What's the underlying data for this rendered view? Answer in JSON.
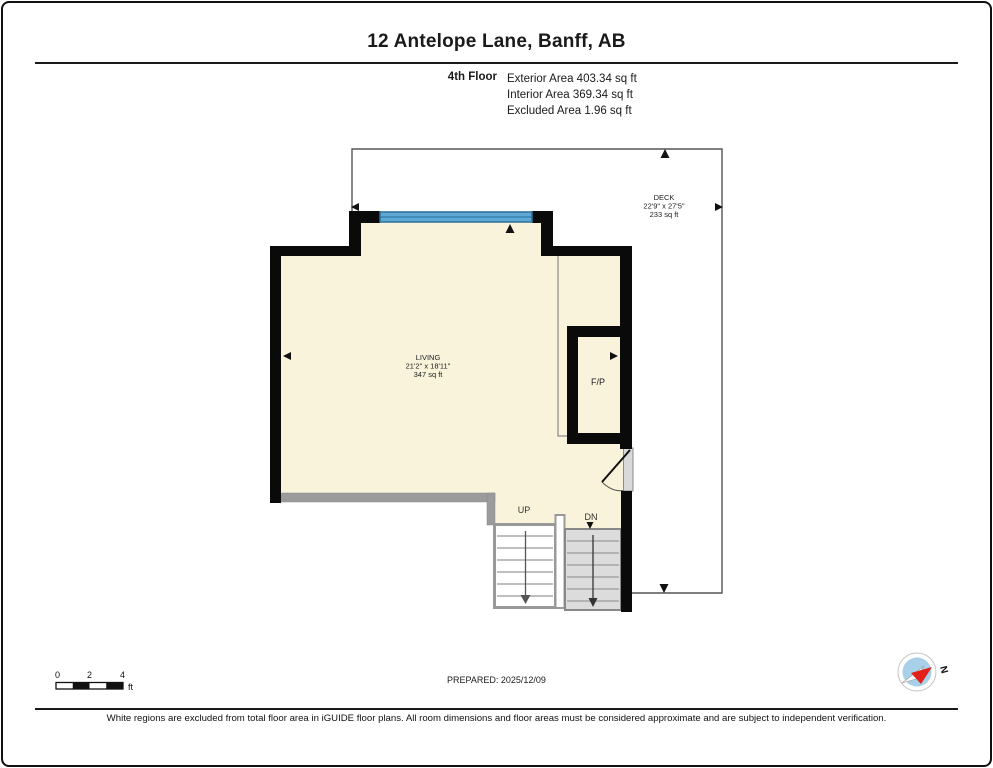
{
  "header": {
    "title": "12 Antelope Lane, Banff, AB",
    "floor_label": "4th Floor",
    "area_lines": [
      "Exterior Area 403.34 sq ft",
      "Interior Area 369.34 sq ft",
      "Excluded Area 1.96 sq ft"
    ]
  },
  "plan": {
    "deck": {
      "name": "DECK",
      "dimensions": "22'9\" x 27'5\"",
      "area": "233 sq ft"
    },
    "living": {
      "name": "LIVING",
      "dimensions": "21'2\" x 18'11\"",
      "area": "347 sq ft"
    },
    "fireplace_label": "F/P",
    "stair_up_label": "UP",
    "stair_down_label": "DN"
  },
  "scale_bar": {
    "tick_0": "0",
    "tick_2": "2",
    "tick_4": "4",
    "unit": "ft"
  },
  "compass": {
    "north_label": "N"
  },
  "footer": {
    "prepared": "PREPARED: 2025/12/09",
    "disclaimer": "White regions are excluded from total floor area in iGUIDE floor plans. All room dimensions and floor areas must be considered approximate and are subject to independent verification."
  },
  "colors": {
    "wall": "#0a0a0a",
    "room_fill": "#faf3dc",
    "window_blue": "#5fa8d3",
    "railing_gray": "#9b9b9b",
    "stair_gray": "#dcdcdc",
    "compass_red": "#e32119",
    "compass_blue": "#a8d0e8"
  }
}
